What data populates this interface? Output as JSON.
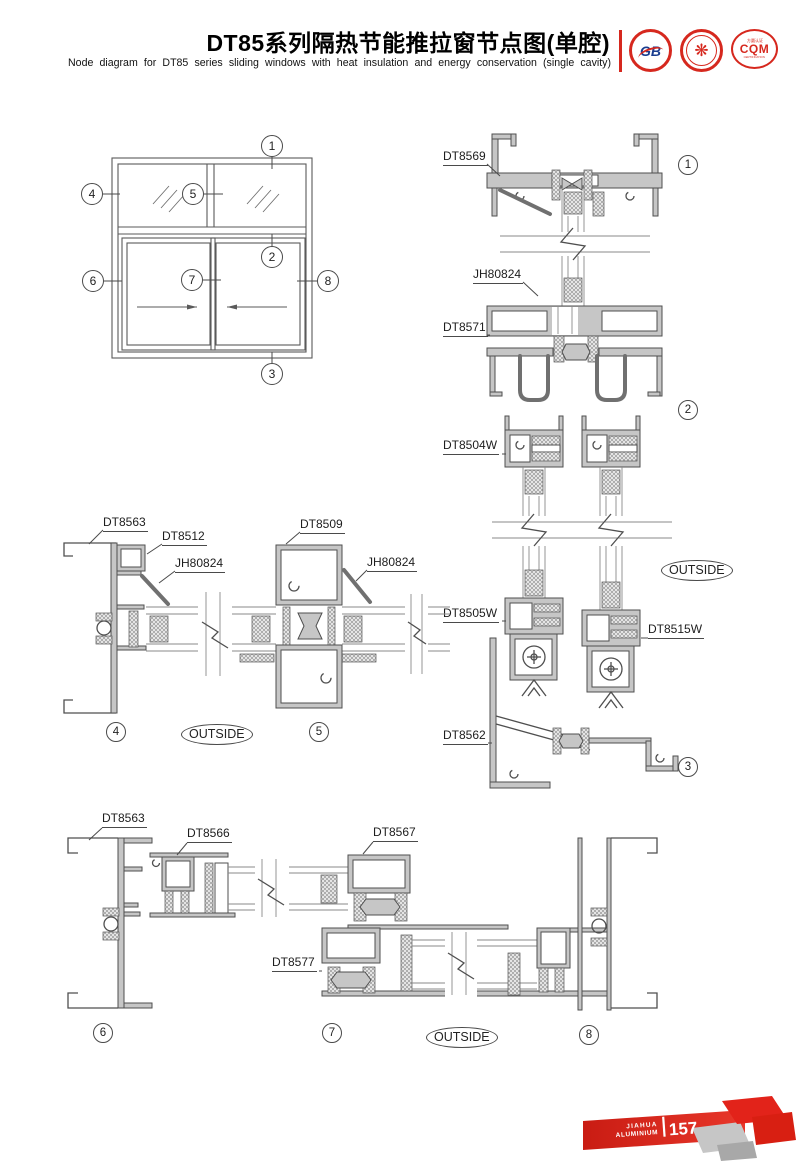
{
  "header": {
    "title_cn": "DT85系列隔热节能推拉窗节点图(单腔)",
    "title_en": "Node diagram for DT85 series sliding windows with heat insulation and energy conservation (single cavity)",
    "logo_gb_text": "GB",
    "logo_cert_glyph": "❋",
    "logo_cqm_top": "方圆认证",
    "logo_cqm_text": "CQM",
    "logo_cqm_bottom": "CERTIFICATION"
  },
  "elevation": {
    "c1": "1",
    "c2": "2",
    "c3": "3",
    "c4": "4",
    "c5": "5",
    "c6": "6",
    "c7": "7",
    "c8": "8"
  },
  "right_section": {
    "dt8569": "DT8569",
    "jh80824": "JH80824",
    "dt8571": "DT8571",
    "dt8504w": "DT8504W",
    "dt8505w": "DT8505W",
    "dt8515w": "DT8515W",
    "dt8562": "DT8562",
    "c1": "1",
    "c2": "2",
    "c3": "3",
    "outside": "OUTSIDE"
  },
  "mid_section": {
    "dt8563": "DT8563",
    "dt8512": "DT8512",
    "jh80824_left": "JH80824",
    "dt8509": "DT8509",
    "jh80824_right": "JH80824",
    "c4": "4",
    "c5": "5",
    "outside": "OUTSIDE"
  },
  "bottom_section": {
    "dt8563": "DT8563",
    "dt8566": "DT8566",
    "dt8567": "DT8567",
    "dt8577": "DT8577",
    "c6": "6",
    "c7": "7",
    "c8": "8",
    "outside": "OUTSIDE"
  },
  "footer": {
    "brand_line1": "JIAHUA",
    "brand_line2": "ALUMINIUM",
    "page_number": "157"
  }
}
